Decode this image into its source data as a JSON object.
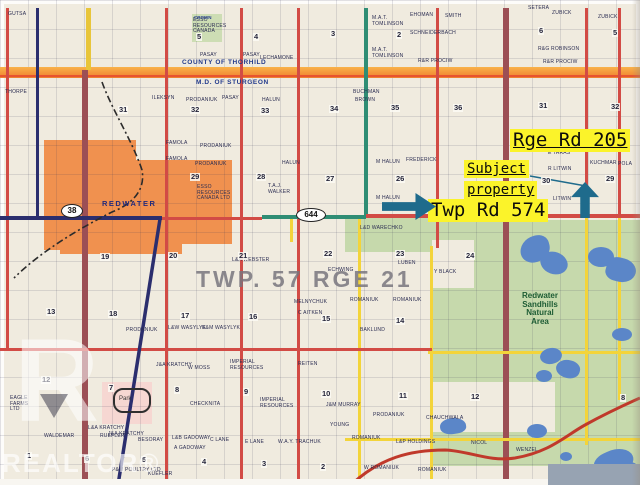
{
  "annotations": {
    "rge_rd_label": "Rge Rd 205",
    "subject_line1": "Subject",
    "subject_line2": "property",
    "twp_rd_label": "Twp Rd 574",
    "highlight_color": "#fbf32a",
    "arrow_color": "#1f6b8c"
  },
  "map_labels": {
    "county_top": "COUNTY OF THORHILD",
    "county_bottom": "M.D. OF STURGEON",
    "town": "REDWATER",
    "township_block": "TWP. 57 RGE 21",
    "natural_area": [
      "Redwater",
      "Sandhills",
      "Natural",
      "Area"
    ],
    "crown": "CROWN",
    "park": "Park",
    "watermark_r": "R",
    "watermark_word": "REALTOR®"
  },
  "highway_markers": [
    {
      "label": "38",
      "x": 61,
      "y": 204
    },
    {
      "label": "644",
      "x": 296,
      "y": 208
    }
  ],
  "colors": {
    "paper": "#f0ebdf",
    "road_red": "#d24b45",
    "road_navy": "#2b2e6e",
    "road_maroon": "#9c4f55",
    "road_teal": "#2f8d74",
    "road_yellow": "#f3d43a",
    "boundary_orange": "#ef7f2e",
    "town_orange": "#f0914f",
    "natural_green": "#c6d9ac",
    "lake_blue": "#5b86c8"
  },
  "roads": [
    {
      "x": 6,
      "y": 8,
      "w": 3,
      "h": 342,
      "c": "#d24b45"
    },
    {
      "x": 36,
      "y": 8,
      "w": 3,
      "h": 212,
      "c": "#2b2e6e"
    },
    {
      "x": 86,
      "y": 8,
      "w": 5,
      "h": 62,
      "c": "#e8c53a"
    },
    {
      "x": 82,
      "y": 70,
      "w": 6,
      "h": 415,
      "c": "#9c4f55"
    },
    {
      "x": 165,
      "y": 8,
      "w": 3,
      "h": 477,
      "c": "#d24b45"
    },
    {
      "x": 240,
      "y": 8,
      "w": 3,
      "h": 477,
      "c": "#d24b45"
    },
    {
      "x": 297,
      "y": 8,
      "w": 3,
      "h": 477,
      "c": "#d24b45"
    },
    {
      "x": 364,
      "y": 8,
      "w": 4,
      "h": 210,
      "c": "#2f8d74"
    },
    {
      "x": 358,
      "y": 218,
      "w": 3,
      "h": 267,
      "c": "#f3d43a"
    },
    {
      "x": 436,
      "y": 8,
      "w": 3,
      "h": 240,
      "c": "#d24b45"
    },
    {
      "x": 430,
      "y": 246,
      "w": 3,
      "h": 239,
      "c": "#f3d43a"
    },
    {
      "x": 503,
      "y": 8,
      "w": 6,
      "h": 477,
      "c": "#9c4f55"
    },
    {
      "x": 585,
      "y": 8,
      "w": 3,
      "h": 208,
      "c": "#d24b45"
    },
    {
      "x": 585,
      "y": 215,
      "w": 3,
      "h": 230,
      "c": "#f3d43a"
    },
    {
      "x": 618,
      "y": 8,
      "w": 3,
      "h": 208,
      "c": "#d24b45"
    },
    {
      "x": 618,
      "y": 215,
      "w": 3,
      "h": 185,
      "c": "#f3d43a"
    },
    {
      "x": 290,
      "y": 218,
      "w": 3,
      "h": 24,
      "c": "#f3d43a"
    },
    {
      "x": 0,
      "y": 216,
      "w": 162,
      "h": 4,
      "c": "#2b2e6e"
    },
    {
      "x": 162,
      "y": 217,
      "w": 100,
      "h": 3,
      "c": "#d24b45"
    },
    {
      "x": 262,
      "y": 215,
      "w": 104,
      "h": 4,
      "c": "#2f8d74"
    },
    {
      "x": 366,
      "y": 214,
      "w": 274,
      "h": 4,
      "c": "#d24b45"
    },
    {
      "x": 0,
      "y": 348,
      "w": 432,
      "h": 3,
      "c": "#d24b45"
    },
    {
      "x": 428,
      "y": 351,
      "w": 212,
      "h": 3,
      "c": "#f3d43a"
    },
    {
      "x": 345,
      "y": 438,
      "w": 295,
      "h": 3,
      "c": "#f3d43a"
    }
  ],
  "patches": [
    {
      "x": 44,
      "y": 140,
      "w": 92,
      "h": 110,
      "c": "#f0914f"
    },
    {
      "x": 134,
      "y": 160,
      "w": 98,
      "h": 84,
      "c": "#f0914f"
    },
    {
      "x": 60,
      "y": 242,
      "w": 122,
      "h": 12,
      "c": "#f0914f"
    },
    {
      "x": 192,
      "y": 14,
      "w": 30,
      "h": 28,
      "c": "#cdddb4"
    },
    {
      "x": 430,
      "y": 220,
      "w": 210,
      "h": 133,
      "c": "#c6d9ac"
    },
    {
      "x": 345,
      "y": 218,
      "w": 88,
      "h": 34,
      "c": "#c6d9ac"
    },
    {
      "x": 430,
      "y": 354,
      "w": 210,
      "h": 112,
      "c": "#c6d9ac"
    },
    {
      "x": 560,
      "y": 441,
      "w": 80,
      "h": 26,
      "c": "#c6d9ac"
    },
    {
      "x": 432,
      "y": 240,
      "w": 42,
      "h": 48,
      "c": "#f0ebdf"
    },
    {
      "x": 430,
      "y": 382,
      "w": 125,
      "h": 50,
      "c": "#f0ebdf"
    },
    {
      "x": 102,
      "y": 382,
      "w": 50,
      "h": 42,
      "c": "#f6d7d2"
    }
  ],
  "lakes": [
    {
      "x": 520,
      "y": 236,
      "w": 30,
      "h": 26,
      "r": "60% 40% 55% 45%",
      "rot": -15
    },
    {
      "x": 540,
      "y": 252,
      "w": 28,
      "h": 22,
      "r": "50%",
      "rot": 20
    },
    {
      "x": 588,
      "y": 247,
      "w": 26,
      "h": 20,
      "r": "50%",
      "rot": 0
    },
    {
      "x": 606,
      "y": 258,
      "w": 30,
      "h": 24,
      "r": "45% 55% 60% 40%",
      "rot": 15
    },
    {
      "x": 612,
      "y": 328,
      "w": 20,
      "h": 13,
      "r": "50%",
      "rot": 0
    },
    {
      "x": 540,
      "y": 348,
      "w": 22,
      "h": 16,
      "r": "50%",
      "rot": -10
    },
    {
      "x": 556,
      "y": 360,
      "w": 24,
      "h": 18,
      "r": "55% 45% 50% 50%",
      "rot": 15
    },
    {
      "x": 536,
      "y": 370,
      "w": 16,
      "h": 12,
      "r": "50%",
      "rot": 0
    },
    {
      "x": 527,
      "y": 424,
      "w": 20,
      "h": 14,
      "r": "50%",
      "rot": 0
    },
    {
      "x": 440,
      "y": 418,
      "w": 26,
      "h": 16,
      "r": "50% 60% 40% 50%",
      "rot": -8
    },
    {
      "x": 594,
      "y": 450,
      "w": 40,
      "h": 26,
      "r": "40% 60% 50% 50%",
      "rot": -25
    },
    {
      "x": 620,
      "y": 462,
      "w": 20,
      "h": 20,
      "r": "50%",
      "rot": 0
    },
    {
      "x": 560,
      "y": 452,
      "w": 12,
      "h": 9,
      "r": "50%",
      "rot": 0
    }
  ],
  "section_numbers": [
    {
      "n": "5",
      "x": 196,
      "y": 33
    },
    {
      "n": "4",
      "x": 253,
      "y": 33
    },
    {
      "n": "3",
      "x": 330,
      "y": 30
    },
    {
      "n": "2",
      "x": 396,
      "y": 31
    },
    {
      "n": "6",
      "x": 538,
      "y": 27
    },
    {
      "n": "5",
      "x": 612,
      "y": 29
    },
    {
      "n": "31",
      "x": 118,
      "y": 106
    },
    {
      "n": "32",
      "x": 190,
      "y": 106
    },
    {
      "n": "33",
      "x": 260,
      "y": 107
    },
    {
      "n": "34",
      "x": 329,
      "y": 105
    },
    {
      "n": "35",
      "x": 390,
      "y": 104
    },
    {
      "n": "36",
      "x": 453,
      "y": 104
    },
    {
      "n": "31",
      "x": 538,
      "y": 102
    },
    {
      "n": "32",
      "x": 610,
      "y": 103
    },
    {
      "n": "29",
      "x": 190,
      "y": 173
    },
    {
      "n": "28",
      "x": 256,
      "y": 173
    },
    {
      "n": "27",
      "x": 325,
      "y": 175
    },
    {
      "n": "26",
      "x": 395,
      "y": 175
    },
    {
      "n": "30",
      "x": 541,
      "y": 177
    },
    {
      "n": "29",
      "x": 605,
      "y": 175
    },
    {
      "n": "19",
      "x": 100,
      "y": 253
    },
    {
      "n": "20",
      "x": 168,
      "y": 252
    },
    {
      "n": "21",
      "x": 238,
      "y": 252
    },
    {
      "n": "22",
      "x": 323,
      "y": 250
    },
    {
      "n": "23",
      "x": 395,
      "y": 250
    },
    {
      "n": "24",
      "x": 465,
      "y": 252
    },
    {
      "n": "13",
      "x": 46,
      "y": 308
    },
    {
      "n": "18",
      "x": 108,
      "y": 310
    },
    {
      "n": "17",
      "x": 180,
      "y": 312
    },
    {
      "n": "16",
      "x": 248,
      "y": 313
    },
    {
      "n": "15",
      "x": 321,
      "y": 315
    },
    {
      "n": "14",
      "x": 395,
      "y": 317
    },
    {
      "n": "12",
      "x": 41,
      "y": 376
    },
    {
      "n": "7",
      "x": 108,
      "y": 384
    },
    {
      "n": "8",
      "x": 174,
      "y": 386
    },
    {
      "n": "9",
      "x": 243,
      "y": 388
    },
    {
      "n": "10",
      "x": 321,
      "y": 390
    },
    {
      "n": "11",
      "x": 398,
      "y": 392
    },
    {
      "n": "12",
      "x": 470,
      "y": 393
    },
    {
      "n": "8",
      "x": 620,
      "y": 394
    },
    {
      "n": "1",
      "x": 26,
      "y": 452
    },
    {
      "n": "6",
      "x": 84,
      "y": 455
    },
    {
      "n": "5",
      "x": 141,
      "y": 456
    },
    {
      "n": "4",
      "x": 201,
      "y": 458
    },
    {
      "n": "3",
      "x": 261,
      "y": 460
    },
    {
      "n": "2",
      "x": 320,
      "y": 463
    }
  ],
  "parcel_names": [
    {
      "t": "GUTSA",
      "x": 8,
      "y": 12
    },
    {
      "t": "THORPE",
      "x": 5,
      "y": 90
    },
    {
      "t": "ESSO\nRESOURCES\nCANADA",
      "x": 193,
      "y": 18
    },
    {
      "t": "PASAY",
      "x": 200,
      "y": 53
    },
    {
      "t": "PASAY",
      "x": 243,
      "y": 53
    },
    {
      "t": "LECHAMONE",
      "x": 260,
      "y": 56
    },
    {
      "t": "ILEKSYN",
      "x": 152,
      "y": 96
    },
    {
      "t": "PRODANIUK",
      "x": 186,
      "y": 98
    },
    {
      "t": "PASAY",
      "x": 222,
      "y": 96
    },
    {
      "t": "HALUN",
      "x": 262,
      "y": 98
    },
    {
      "t": "BUCHMAN",
      "x": 353,
      "y": 90
    },
    {
      "t": "BROWN",
      "x": 355,
      "y": 98
    },
    {
      "t": "M.A.T.\nTOMLINSON",
      "x": 372,
      "y": 16
    },
    {
      "t": "M.A.T.\nTOMLINSON",
      "x": 372,
      "y": 48
    },
    {
      "t": "EHOMAN",
      "x": 410,
      "y": 13
    },
    {
      "t": "SCHNEIDERBACH",
      "x": 410,
      "y": 31
    },
    {
      "t": "SMITH",
      "x": 445,
      "y": 14
    },
    {
      "t": "R&R PROCIW",
      "x": 418,
      "y": 59
    },
    {
      "t": "SETERA",
      "x": 528,
      "y": 6
    },
    {
      "t": "ZUBICK",
      "x": 552,
      "y": 11
    },
    {
      "t": "ZUBICK",
      "x": 598,
      "y": 15
    },
    {
      "t": "R&G ROBINSON",
      "x": 538,
      "y": 47
    },
    {
      "t": "R&R PROCIW",
      "x": 543,
      "y": 60
    },
    {
      "t": "FAMOLA",
      "x": 166,
      "y": 141
    },
    {
      "t": "FAMOLA",
      "x": 166,
      "y": 157
    },
    {
      "t": "PRODANIUK",
      "x": 200,
      "y": 144
    },
    {
      "t": "PRODANIUK",
      "x": 195,
      "y": 162
    },
    {
      "t": "HALUN",
      "x": 282,
      "y": 161
    },
    {
      "t": "T.A.J.\nWALKER",
      "x": 268,
      "y": 184
    },
    {
      "t": "M HALUN",
      "x": 376,
      "y": 160
    },
    {
      "t": "M HALUN",
      "x": 376,
      "y": 196
    },
    {
      "t": "FREDERICK",
      "x": 406,
      "y": 158
    },
    {
      "t": "E TARAS",
      "x": 548,
      "y": 151
    },
    {
      "t": "R LITWIN",
      "x": 548,
      "y": 167
    },
    {
      "t": "KUCHMAR",
      "x": 590,
      "y": 161
    },
    {
      "t": "POLA",
      "x": 618,
      "y": 162
    },
    {
      "t": "LITWIN",
      "x": 553,
      "y": 197
    },
    {
      "t": "ESSO\nRESOURCES\nCANADA LTD",
      "x": 197,
      "y": 185
    },
    {
      "t": "L&D WARECHKO",
      "x": 360,
      "y": 226
    },
    {
      "t": "EAGLE\nFARMS\nLTD",
      "x": 10,
      "y": 396
    },
    {
      "t": "PRODANIUK",
      "x": 126,
      "y": 328
    },
    {
      "t": "L&W WASYLYK",
      "x": 168,
      "y": 326
    },
    {
      "t": "E&M WASYLYK",
      "x": 202,
      "y": 326
    },
    {
      "t": "L&A WEBSTER",
      "x": 232,
      "y": 258
    },
    {
      "t": "MELNYCHUK",
      "x": 294,
      "y": 300
    },
    {
      "t": "C AITKEN",
      "x": 298,
      "y": 311
    },
    {
      "t": "J&A KRATCHY",
      "x": 156,
      "y": 363
    },
    {
      "t": "W MOSS",
      "x": 188,
      "y": 366
    },
    {
      "t": "IMPERIAL\nRESOURCES",
      "x": 230,
      "y": 360
    },
    {
      "t": "IMPERIAL\nRESOURCES",
      "x": 260,
      "y": 398
    },
    {
      "t": "CHECKNITA",
      "x": 190,
      "y": 402
    },
    {
      "t": "REITEN",
      "x": 298,
      "y": 362
    },
    {
      "t": "L&A KRATCHY",
      "x": 88,
      "y": 426
    },
    {
      "t": "RUEFLER",
      "x": 100,
      "y": 434
    },
    {
      "t": "BESORAY",
      "x": 138,
      "y": 438
    },
    {
      "t": "L&B GADOWAY",
      "x": 172,
      "y": 436
    },
    {
      "t": "A GADOWAY",
      "x": 174,
      "y": 446
    },
    {
      "t": "C LANE",
      "x": 210,
      "y": 438
    },
    {
      "t": "E LANE",
      "x": 245,
      "y": 440
    },
    {
      "t": "W.A.Y. TRACHUK",
      "x": 278,
      "y": 440
    },
    {
      "t": "J&A KRATCHY",
      "x": 108,
      "y": 432
    },
    {
      "t": "P&M POULTRY LTD",
      "x": 112,
      "y": 468
    },
    {
      "t": "KUEFLER",
      "x": 148,
      "y": 472
    },
    {
      "t": "WALDEMAR",
      "x": 44,
      "y": 434
    },
    {
      "t": "ECHWING",
      "x": 328,
      "y": 268
    },
    {
      "t": "ROMANIUK",
      "x": 350,
      "y": 298
    },
    {
      "t": "ROMANIUK",
      "x": 393,
      "y": 298
    },
    {
      "t": "BAKLUND",
      "x": 360,
      "y": 328
    },
    {
      "t": "LUBEN",
      "x": 398,
      "y": 261
    },
    {
      "t": "Y BLACK",
      "x": 434,
      "y": 270
    },
    {
      "t": "J&M MURRAY",
      "x": 326,
      "y": 403
    },
    {
      "t": "YOUNG",
      "x": 330,
      "y": 423
    },
    {
      "t": "PRODANIUK",
      "x": 373,
      "y": 413
    },
    {
      "t": "CHAUCHWALA",
      "x": 426,
      "y": 416
    },
    {
      "t": "ROMANIUK",
      "x": 352,
      "y": 436
    },
    {
      "t": "L&P HOLDINGS",
      "x": 396,
      "y": 440
    },
    {
      "t": "NICOL",
      "x": 471,
      "y": 441
    },
    {
      "t": "WENZEL",
      "x": 516,
      "y": 448
    },
    {
      "t": "W ROMANIUK",
      "x": 364,
      "y": 466
    },
    {
      "t": "ROMANIUK",
      "x": 418,
      "y": 468
    }
  ]
}
